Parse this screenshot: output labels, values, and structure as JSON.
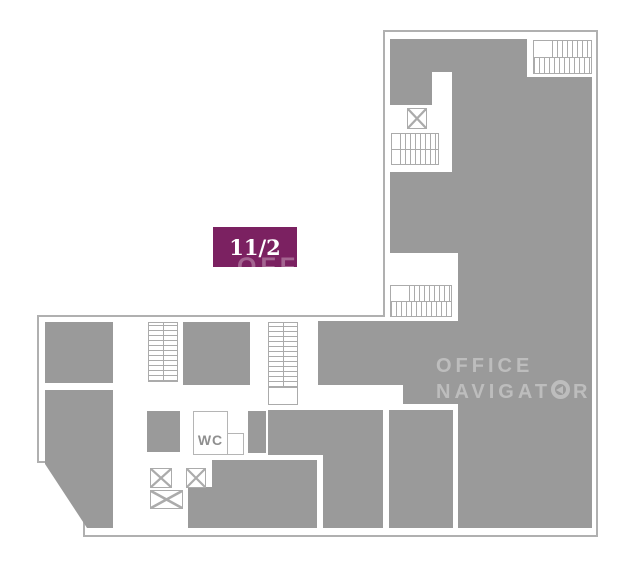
{
  "plan": {
    "badge": {
      "label": "11/2",
      "color": "#7b2161",
      "text_color": "#ffffff"
    },
    "wc": {
      "label": "WC"
    },
    "watermark": {
      "line1": "OFFICE",
      "line2_pre": "NAVIGAT",
      "line2_post": "R"
    },
    "watermark_overlay": {
      "text": "OFFICE"
    },
    "icons": {
      "stairs": "stairs-icon",
      "elevator": "elevator-icon",
      "logo_o": "navigator-logo-o-icon"
    },
    "colors": {
      "room": "#9a9a9a",
      "outline": "#b0b0b0",
      "iconline": "#ababab",
      "badge": "#7b2161",
      "watermark": "#bdbdbd",
      "wctext": "#8f8f8f"
    }
  }
}
